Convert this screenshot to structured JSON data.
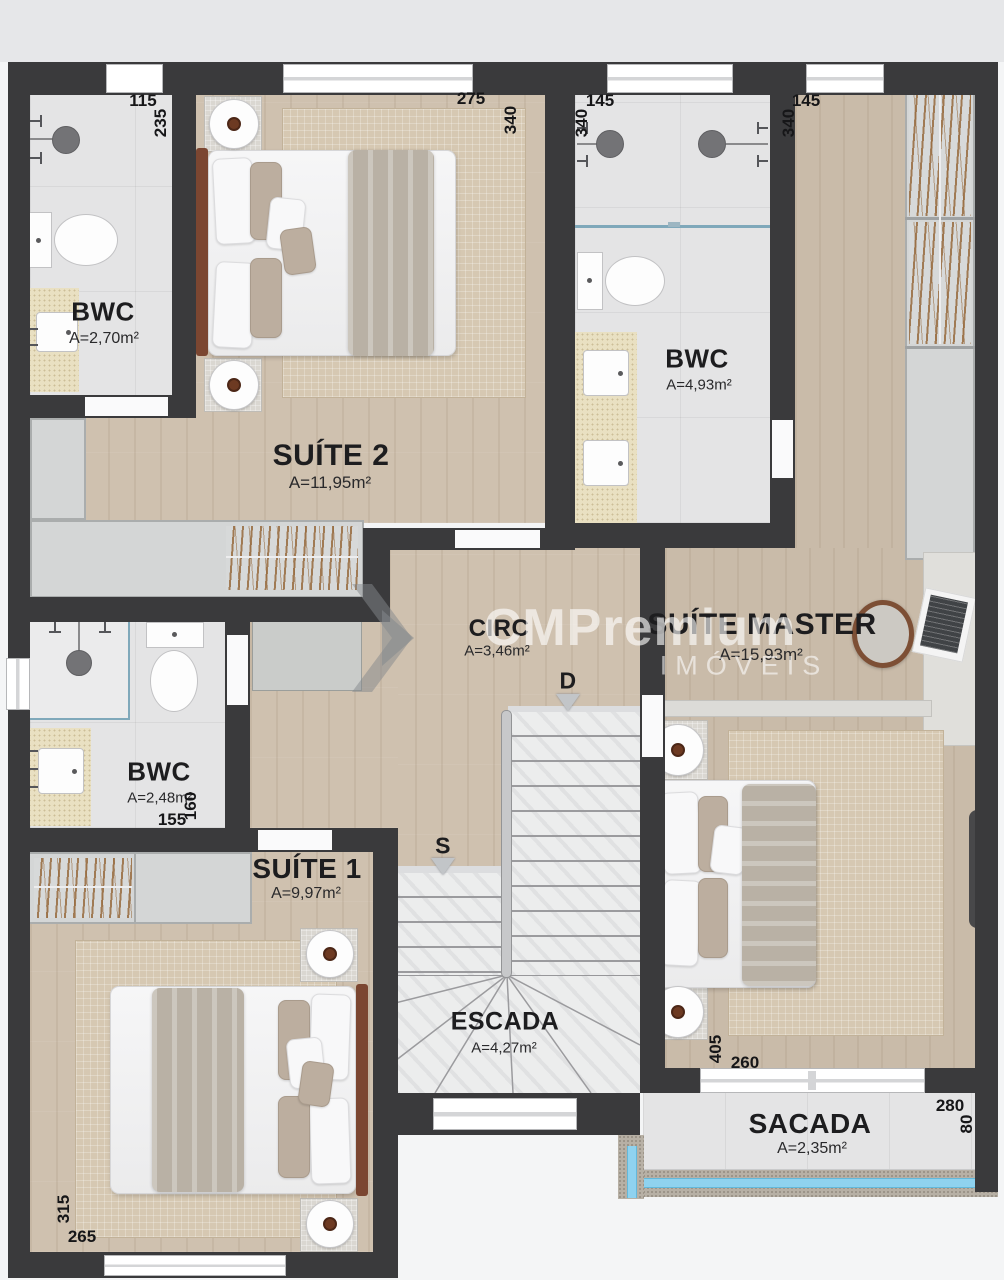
{
  "plan": {
    "rooms": {
      "bwc_suite2": {
        "name": "BWC",
        "area": "A=2,70m²"
      },
      "suite2": {
        "name": "SUÍTE 2",
        "area": "A=11,95m²"
      },
      "bwc_master": {
        "name": "BWC",
        "area": "A=4,93m²"
      },
      "suite_master": {
        "name": "SUÍTE MASTER",
        "area": "A=15,93m²"
      },
      "circ": {
        "name": "CIRC",
        "area": "A=3,46m²"
      },
      "bwc_suite1": {
        "name": "BWC",
        "area": "A=2,48m²"
      },
      "suite1": {
        "name": "SUÍTE 1",
        "area": "A=9,97m²"
      },
      "escada": {
        "name": "ESCADA",
        "area": "A=4,27m²"
      },
      "sacada": {
        "name": "SACADA",
        "area": "A=2,35m²"
      }
    },
    "dimensions": {
      "bwc_suite2_w": "115",
      "bwc_suite2_h": "235",
      "suite2_w": "275",
      "suite2_h": "340",
      "bwc_master_w": "145",
      "bwc_master_h": "340",
      "suite_master_w": "145",
      "suite_master_h": "340",
      "master_bed_w": "260",
      "master_bed_h": "405",
      "bwc_suite1_w": "155",
      "bwc_suite1_h": "160",
      "suite1_w": "265",
      "suite1_h": "315",
      "sacada_w": "280",
      "sacada_h": "80"
    },
    "stairs": {
      "up": "S",
      "down": "D"
    },
    "watermark": {
      "brand": "CMPremium",
      "tagline": "IMÓVEIS"
    },
    "colors": {
      "wall": "#3a3a3c",
      "wood_floor": "#cfc1af",
      "tile_floor": "#e4e4e5",
      "counter": "#e9e0c2",
      "rug": "#d6c8b2",
      "wardrobe": "#d4d6d6",
      "marble": "#eceded",
      "glass_railing": "#8fd2ef",
      "concrete": "#b7b0a5",
      "headboard": "#7b4631",
      "blanket": "#b9b1a5"
    }
  }
}
